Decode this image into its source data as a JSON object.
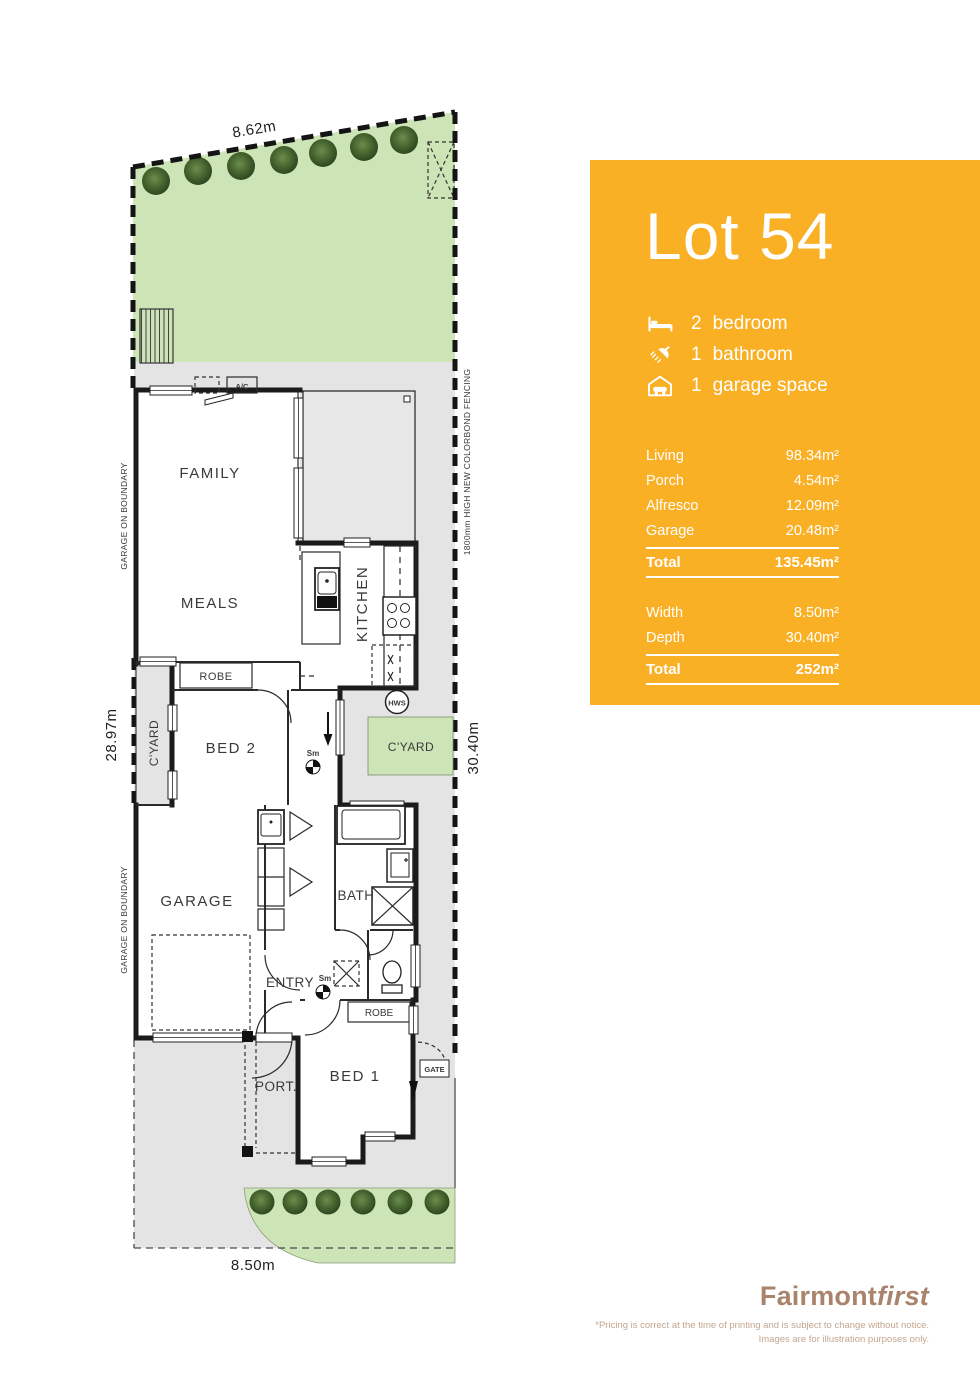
{
  "panel": {
    "accent_color": "#FAB025",
    "title": "Lot 54",
    "features": [
      {
        "icon": "bed-icon",
        "count": "2",
        "label": "bedroom"
      },
      {
        "icon": "shower-icon",
        "count": "1",
        "label": "bathroom"
      },
      {
        "icon": "garage-icon",
        "count": "1",
        "label": "garage space"
      }
    ],
    "area_table": {
      "rows": [
        {
          "label": "Living",
          "value": "98.34m²"
        },
        {
          "label": "Porch",
          "value": "4.54m²"
        },
        {
          "label": "Alfresco",
          "value": "12.09m²"
        },
        {
          "label": "Garage",
          "value": "20.48m²"
        }
      ],
      "total": {
        "label": "Total",
        "value": "135.45m²"
      }
    },
    "dimension_table": {
      "rows": [
        {
          "label": "Width",
          "value": "8.50m²"
        },
        {
          "label": "Depth",
          "value": "30.40m²"
        }
      ],
      "total": {
        "label": "Total",
        "value": "252m²"
      }
    }
  },
  "plan": {
    "site_dimensions": {
      "top": "8.62m",
      "bottom": "8.50m",
      "left": "28.97m",
      "right": "30.40m"
    },
    "boundary_notes": {
      "garage_on_boundary": "GARAGE ON BOUNDARY",
      "fence": "1800mm HIGH NEW COLORBOND FENCING"
    },
    "rooms": {
      "family": "FAMILY",
      "meals": "MEALS",
      "kitchen": "KITCHEN",
      "robe_bed2": "ROBE",
      "bed2": "BED 2",
      "cyard_left": "C'YARD",
      "cyard_right": "C'YARD",
      "garage": "GARAGE",
      "bath": "BATH",
      "entry": "ENTRY",
      "robe_bed1": "ROBE",
      "bed1": "BED 1",
      "porch": "PORT.",
      "gate": "GATE"
    },
    "markers": {
      "ac": "A/C",
      "hws": "HWS",
      "smoke": "Sm"
    },
    "colors": {
      "garden_green": "#CDE4B6",
      "site_grey": "#E4E4E4",
      "wall_black": "#1B1B1B"
    }
  },
  "footer": {
    "brand": {
      "bold": "Fairmont",
      "italic": "first"
    },
    "disclaimer": [
      "*Pricing is correct at the time of printing and is subject to change without notice.",
      "Images are for illustration purposes only."
    ]
  }
}
